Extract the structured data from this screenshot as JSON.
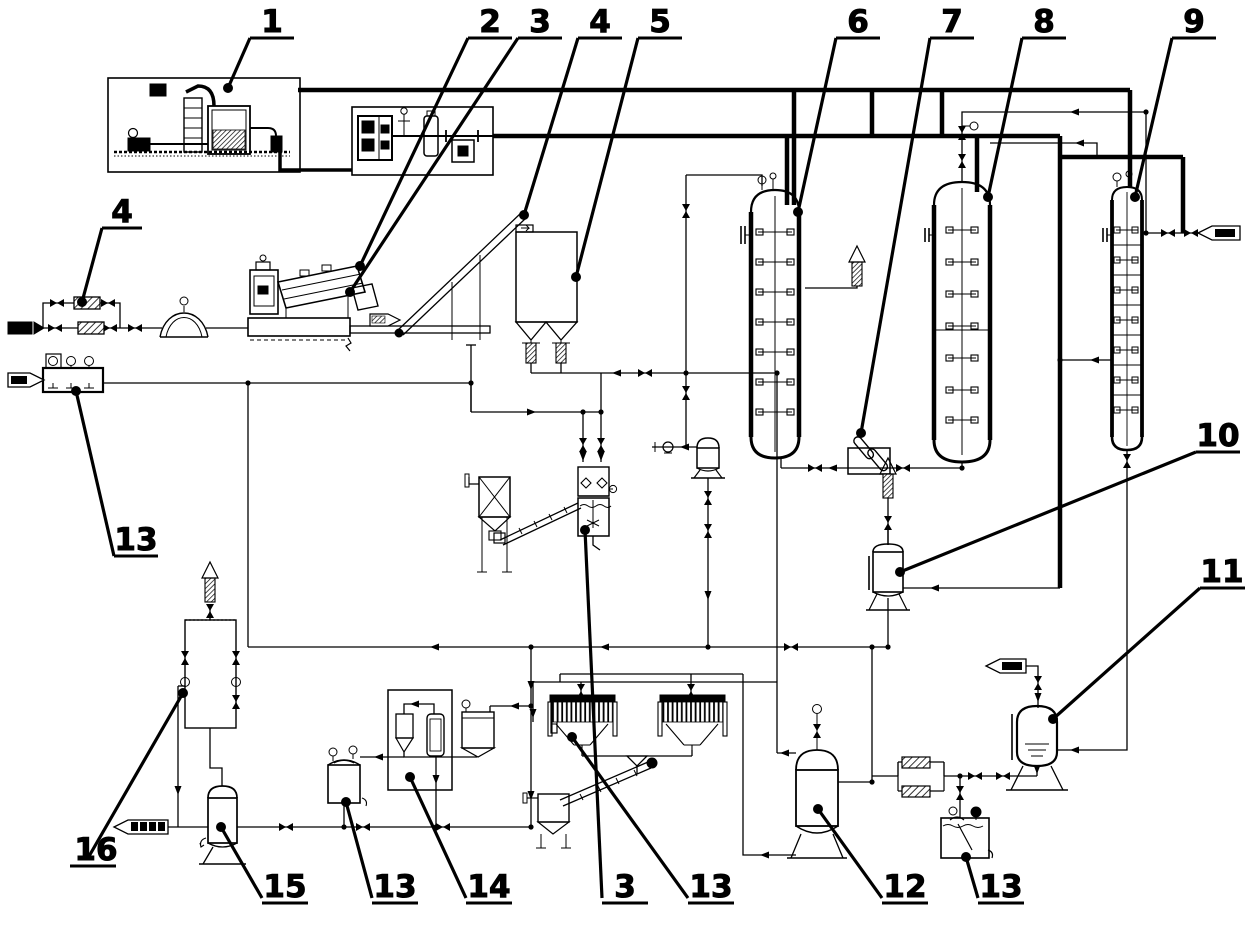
{
  "canvas": {
    "background": "#ffffff",
    "ink": "#000000"
  },
  "callouts": [
    {
      "label": "1",
      "target": "thermal-oil-furnace-unit"
    },
    {
      "label": "2",
      "target": "mill-drive"
    },
    {
      "label": "3",
      "target": "mill-drum"
    },
    {
      "label": "4",
      "target": "inclined-conveyor-head"
    },
    {
      "label": "5",
      "target": "storage-silo"
    },
    {
      "label": "6",
      "target": "column-reactor-1"
    },
    {
      "label": "7",
      "target": "inline-heater"
    },
    {
      "label": "8",
      "target": "column-reactor-2"
    },
    {
      "label": "9",
      "target": "column-reactor-3"
    },
    {
      "label": "4",
      "target": "feed-heat-exchanger"
    },
    {
      "label": "13",
      "target": "dosing-tank-left"
    },
    {
      "label": "10",
      "target": "knockout-drum"
    },
    {
      "label": "11",
      "target": "receiver-vessel"
    },
    {
      "label": "16",
      "target": "scrubber-column"
    },
    {
      "label": "15",
      "target": "pump-vessel"
    },
    {
      "label": "13",
      "target": "middle-tank"
    },
    {
      "label": "14",
      "target": "dryer-unit"
    },
    {
      "label": "3",
      "target": "mixing-tank"
    },
    {
      "label": "13",
      "target": "filter-press"
    },
    {
      "label": "12",
      "target": "collection-vessel"
    },
    {
      "label": "13",
      "target": "agitated-tank-right"
    }
  ],
  "streams": [
    {
      "name": "inlet-left-upper",
      "arrow": "right"
    },
    {
      "name": "inlet-left-lower",
      "arrow": "right"
    },
    {
      "name": "mill-discharge",
      "arrow": "right"
    },
    {
      "name": "inlet-right",
      "arrow": "left"
    },
    {
      "name": "inlet-to-vessel-11",
      "arrow": "left"
    },
    {
      "name": "outlet-bottom-left",
      "arrow": "left"
    }
  ],
  "equipment": [
    "thermal-oil-furnace",
    "dosing-skid",
    "ball-mill",
    "inclined-conveyor",
    "storage-silo",
    "bag-filter",
    "mixing-tank",
    "column-reactor-1",
    "inline-heater",
    "column-reactor-2",
    "column-reactor-3",
    "seal-pot",
    "knockout-drum",
    "receiver-vessel",
    "collection-vessel",
    "heat-exchanger-pair",
    "agitated-tank",
    "scrubber-column",
    "pump-vessel",
    "middle-tank",
    "dryer-unit",
    "filter-press-1",
    "filter-press-2",
    "screw-conveyor",
    "discharge-hopper",
    "vent-stack"
  ]
}
